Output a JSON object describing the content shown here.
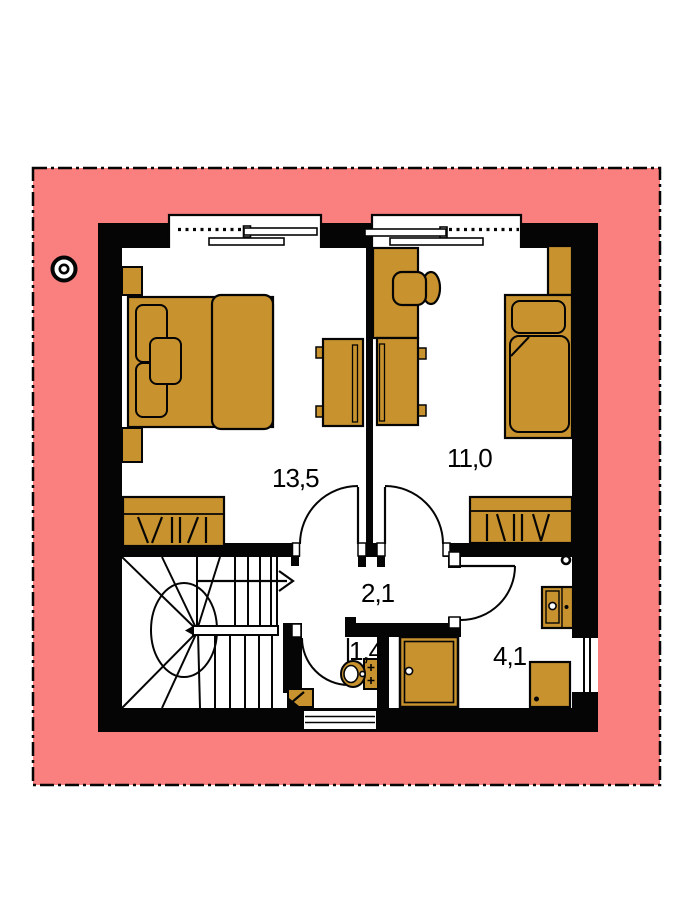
{
  "plan": {
    "type": "floor-plan",
    "rooms": [
      {
        "name": "bedroom-left",
        "area_label": "13,5"
      },
      {
        "name": "bedroom-right",
        "area_label": "11,0"
      },
      {
        "name": "hall",
        "area_label": "2,1"
      },
      {
        "name": "wc",
        "area_label": "1,4"
      },
      {
        "name": "bathroom",
        "area_label": "4,1"
      }
    ],
    "symbols": {
      "stair_arrow": "up-direction-arrow-icon",
      "chimney": "chimney-icon",
      "plot_boundary": "dash-dot-property-line"
    }
  },
  "colors": {
    "plot_pink": "#FA7F7F",
    "furniture_tan": "#C8932E",
    "wall_black": "#050505",
    "paper_white": "#FFFFFF"
  }
}
